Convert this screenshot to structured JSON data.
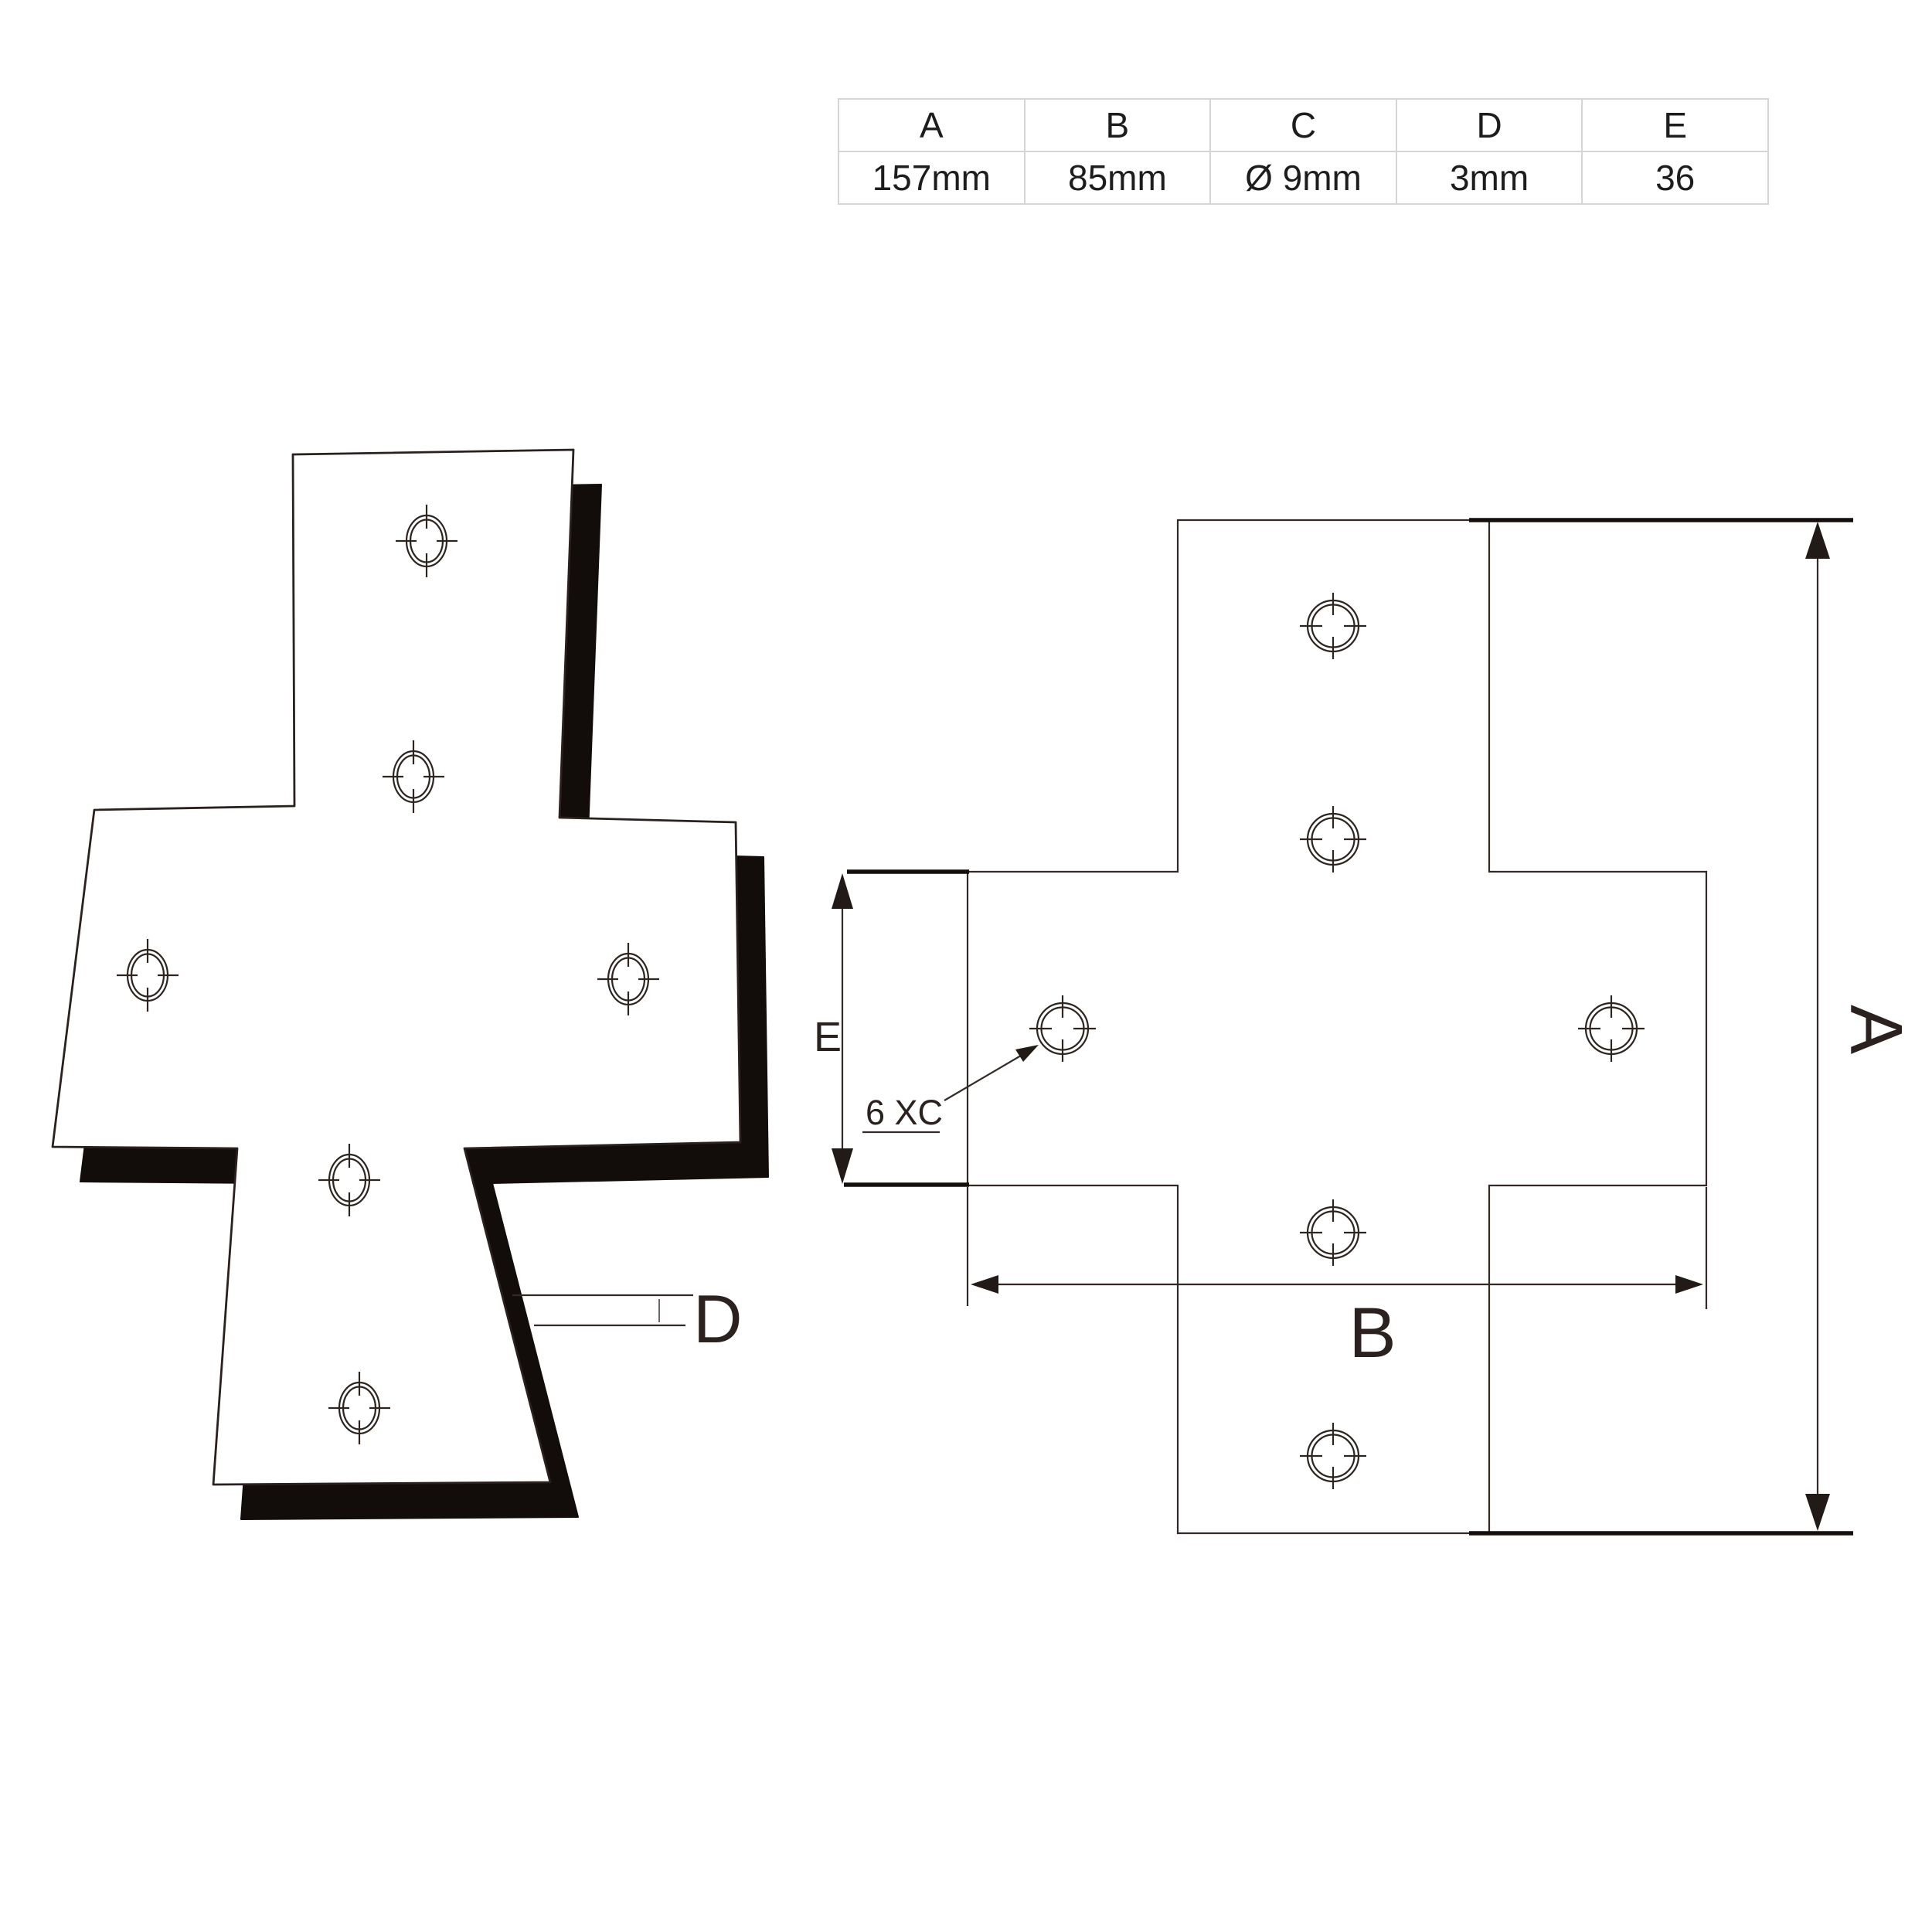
{
  "spec_table": {
    "headers": [
      "A",
      "B",
      "C",
      "D",
      "E"
    ],
    "values": [
      "157mm",
      "85mm",
      "Ø 9mm",
      "3mm",
      "36"
    ]
  },
  "drawing_labels": {
    "dim_a": "A",
    "dim_b": "B",
    "dim_d": "D",
    "dim_e": "E",
    "holes_note": "6 XC"
  },
  "colors": {
    "line": "#332a27",
    "thick_line": "#140e0c",
    "iso_side_fill": "#120c0a",
    "table_border": "#d5d5d5",
    "table_text": "#1d1d1d"
  }
}
